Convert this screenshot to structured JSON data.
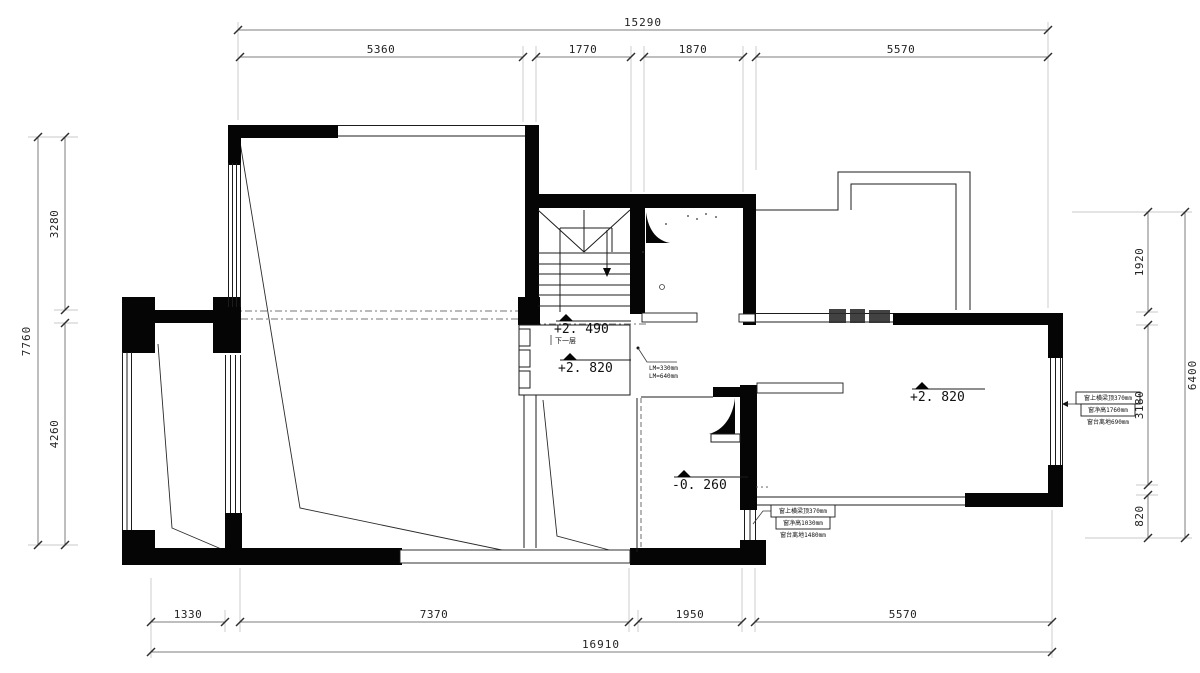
{
  "dims": {
    "top": {
      "total": "15290",
      "s1": "5360",
      "s2": "1770",
      "s3": "1870",
      "s4": "5570"
    },
    "bottom": {
      "total": "16910",
      "s1": "1330",
      "s2": "7370",
      "s3": "1950",
      "s4": "5570"
    },
    "left": {
      "total": "7760",
      "s1": "3280",
      "s2": "4260"
    },
    "right": {
      "total": "6400",
      "s1": "1920",
      "s2": "3180",
      "s3": "820"
    }
  },
  "levels": {
    "stair": "+2. 490",
    "landing": "+2. 820",
    "right_room": "+2. 820",
    "sunken": "-0. 260"
  },
  "notes": {
    "down": "下一层",
    "lm1": "LM=330mm",
    "lm2": "LM=640mm"
  },
  "win_right": {
    "l1": "窗上横梁顶370mm",
    "l2": "窗净高1760mm",
    "l3": "窗台离地690mm"
  },
  "win_bottom": {
    "l1": "窗上横梁顶370mm",
    "l2": "窗净高1030mm",
    "l3": "窗台离地1480mm"
  }
}
